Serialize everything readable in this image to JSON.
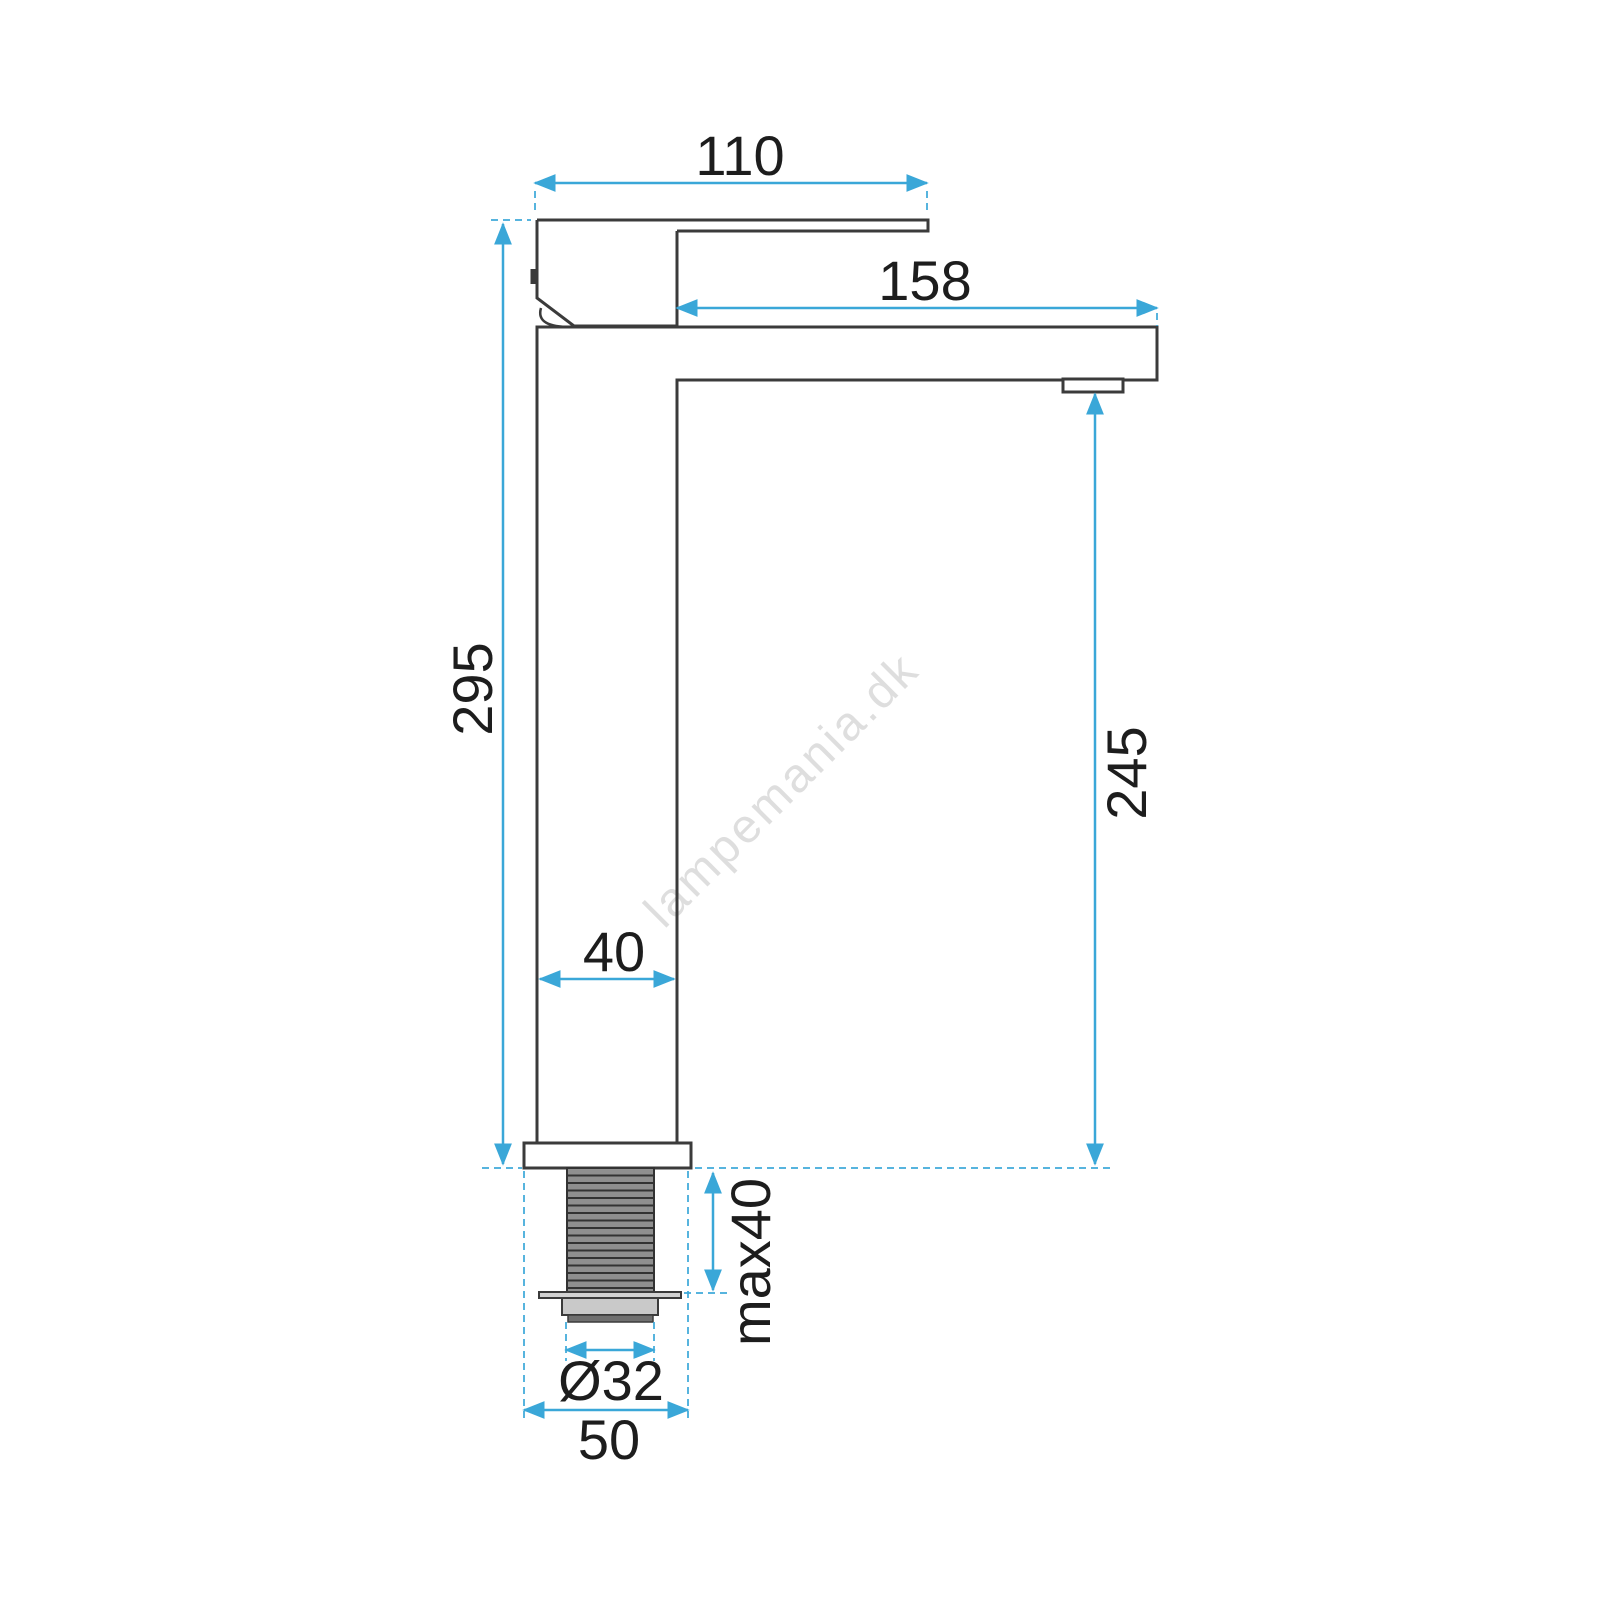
{
  "drawing": {
    "type": "technical-dimension-drawing",
    "subject": "tall single-lever basin mixer faucet, side view",
    "watermark": "lampemania.dk",
    "colors": {
      "outline": "#3b3b3b",
      "dimension_accent": "#3aa7d8",
      "label_text": "#1d1d1d",
      "watermark": "#c4c4c4",
      "thread_fill": "#8f8f8f",
      "washer_fill": "#d2d2d2",
      "nut_fill": "#c9c9c9",
      "nut_lower_fill": "#6f6f6f",
      "background": "#ffffff"
    },
    "dimensions": {
      "handle_length": "110",
      "spout_reach": "158",
      "total_height": "295",
      "spout_height": "245",
      "body_width": "40",
      "max_mount_thickness": "max40",
      "thread_diameter": "Ø32",
      "base_width": "50"
    }
  }
}
